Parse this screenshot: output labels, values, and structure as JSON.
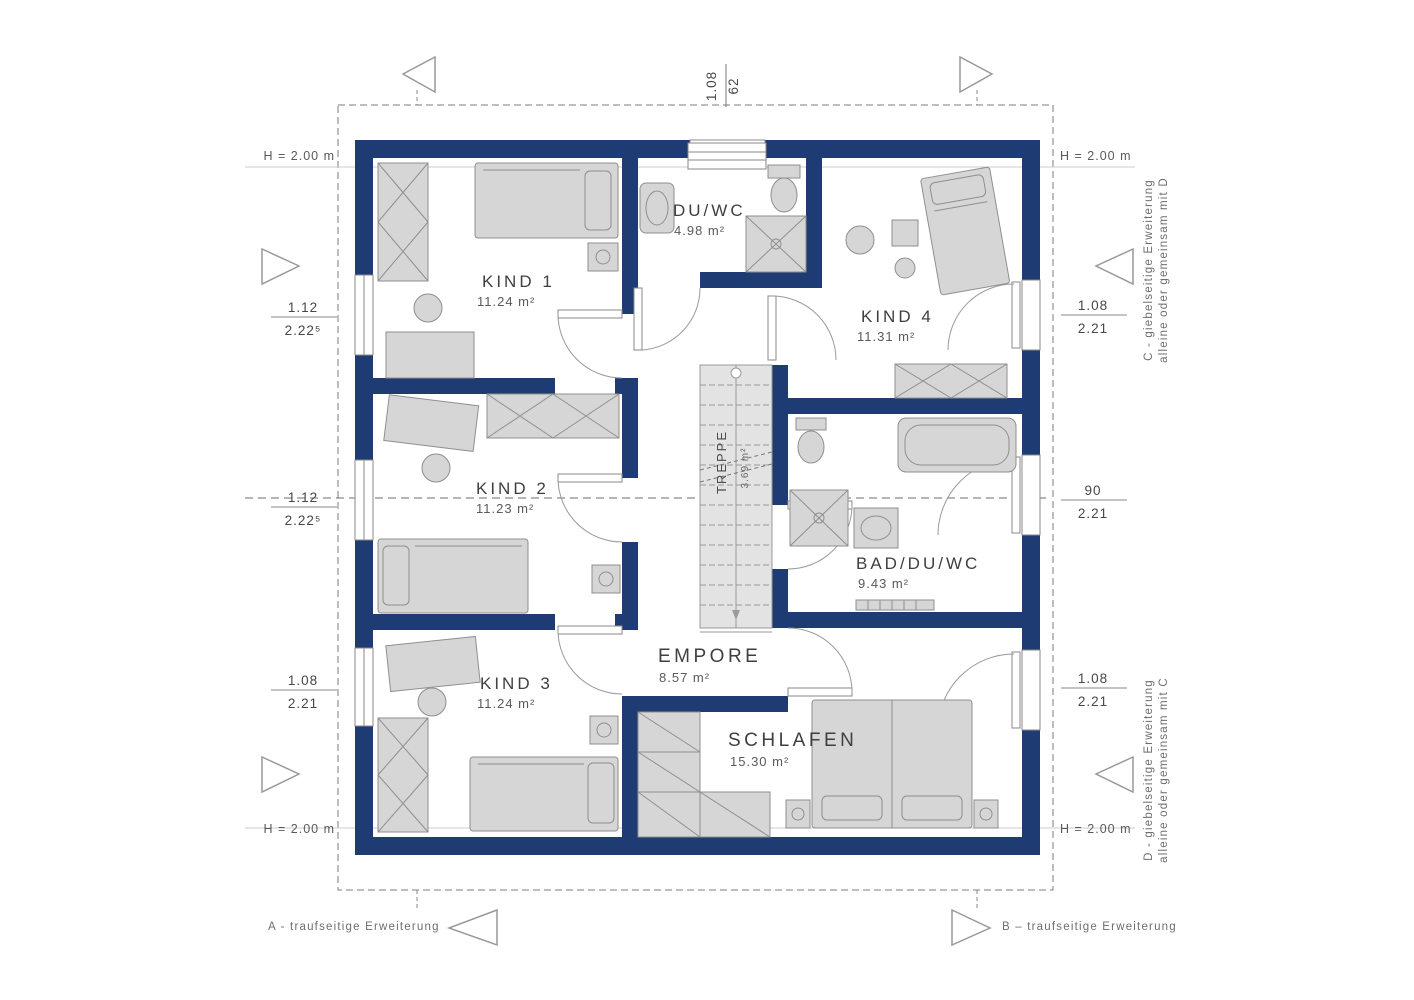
{
  "plan": {
    "rooms": [
      {
        "name": "KIND 1",
        "area": "11.24 m²"
      },
      {
        "name": "DU/WC",
        "area": "4.98 m²"
      },
      {
        "name": "KIND 4",
        "area": "11.31 m²"
      },
      {
        "name": "KIND 2",
        "area": "11.23 m²"
      },
      {
        "name": "BAD/DU/WC",
        "area": "9.43 m²"
      },
      {
        "name": "KIND 3",
        "area": "11.24 m²"
      },
      {
        "name": "EMPORE",
        "area": "8.57 m²"
      },
      {
        "name": "SCHLAFEN",
        "area": "15.30 m²"
      },
      {
        "name": "TREPPE",
        "area": "3.69 m²"
      }
    ],
    "dimensions": {
      "top": {
        "upper": "1.08",
        "lower": "62"
      },
      "left": [
        {
          "upper": "1.12",
          "lower": "2.22⁵"
        },
        {
          "upper": "1.12",
          "lower": "2.22⁵"
        },
        {
          "upper": "1.08",
          "lower": "2.21"
        }
      ],
      "right": [
        {
          "upper": "1.08",
          "lower": "2.21"
        },
        {
          "upper": "90",
          "lower": "2.21"
        },
        {
          "upper": "1.08",
          "lower": "2.21"
        }
      ],
      "height_label": "H = 2.00 m"
    },
    "annotations": {
      "bottom_left": "A - traufseitige Erweiterung",
      "bottom_right": "B – traufseitige Erweiterung",
      "right_top_line1": "C - giebelseitige Erweiterung",
      "right_top_line2": "alleine oder gemeinsam mit D",
      "right_bottom_line1": "D - giebelseitige Erweiterung",
      "right_bottom_line2": "alleine oder gemeinsam mit C"
    },
    "colors": {
      "wall": "#1f3b73",
      "furniture": "#d6d6d6",
      "stairs": "#e3e3e3",
      "lines": "#8a8a8a",
      "text": "#3f3f3f"
    }
  }
}
